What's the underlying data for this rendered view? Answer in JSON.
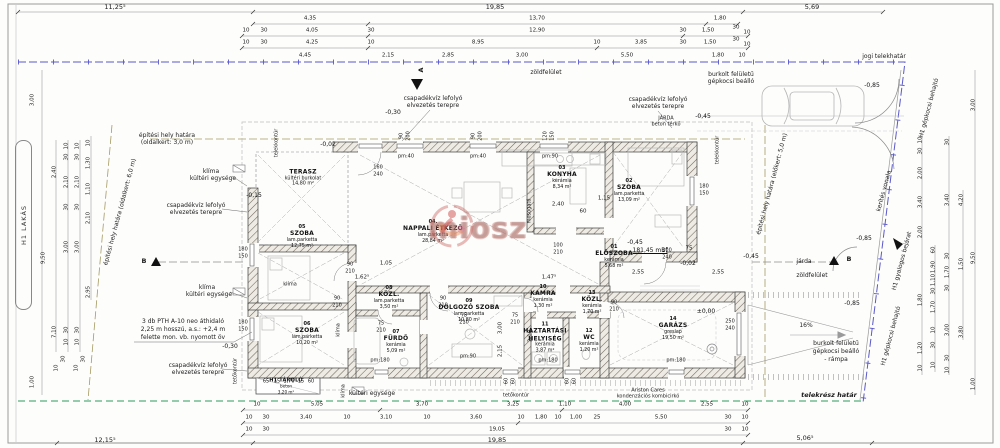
{
  "watermark": {
    "text": "miosz"
  },
  "markers": {
    "a": "A",
    "b": "B"
  },
  "site": {
    "jogi_telekhatar": "jogi telekhatár",
    "telekresz_hatar": "telekrész határ",
    "kerites_vonala": "kerítés vonala",
    "zoldfelulet_top": "zöldfelület",
    "zoldfelulet_bottom": "zöldfelület",
    "jarda_small": "járda",
    "jarda_line1": "JÁRDA",
    "jarda_line2": "beton térkő",
    "burkolt_line1": "burkolt felületű",
    "burkolt_line2": "gépkocsi beálló",
    "rampa_line1": "burkolt felületű",
    "rampa_line2": "gépkocsi beálló",
    "rampa_line3": "- rámpa",
    "slope": "16%",
    "h1_lakas": "H1 LAKÁS",
    "h1_gyalogos": "H1 gyalogos bejárat",
    "h1_gepkocsi": "H1 gépkocsi behajtó",
    "oldalkert3_line1": "építési hely határa",
    "oldalkert3_line2": "(oldalkert: 3,0 m)",
    "oldalkert6": "építési hely határa (oldalkert: 6,0 m)",
    "elokert5": "építési hely határa (előkert: 5,0 m)",
    "telekkontur": "telekkontúr",
    "tetokontur": "tetőkontúr"
  },
  "annotations": {
    "csapadek_line1": "csapadékvíz lefolyó",
    "csapadek_line2": "elvezetés terepre",
    "pth_line1": "3 db PTH A-10 neo áthidaló",
    "pth_line2": "2,25 m hosszú, a.s.: +2,4 m",
    "pth_line3": "felette mon. vb. nyomott öv",
    "klima": "klíma",
    "kulteri_egyseg": "kültéri egysége",
    "mosogato": "mosogató",
    "boiler_line1": "Ariston Cares",
    "boiler_line2": "kondenzációs kombicirkó",
    "benchmark": "181,45 mBf"
  },
  "levels": {
    "m002": "-0,02",
    "m015": "-0,15",
    "m030": "-0,30",
    "m045": "-0,45",
    "m085": "-0,85",
    "zero": "±0,00"
  },
  "rooms": [
    {
      "num": "01",
      "name": "ELŐSZOBA",
      "name2": "",
      "finish": "kerámia",
      "area": "5,68 m²"
    },
    {
      "num": "02",
      "name": "SZOBA",
      "name2": "",
      "finish": "lam.parketta",
      "area": "13,09 m²"
    },
    {
      "num": "03",
      "name": "KONYHA",
      "name2": "",
      "finish": "kerámia",
      "area": "8,34 m²"
    },
    {
      "num": "04.",
      "name": "NAPPALI ÉTKEZŐ",
      "name2": "",
      "finish": "lam.parketta",
      "area": "28,84 m²"
    },
    {
      "num": "05",
      "name": "SZOBA",
      "name2": "",
      "finish": "lam.parketta",
      "area": "12,75 m²"
    },
    {
      "num": "06",
      "name": "SZOBA",
      "name2": "",
      "finish": "lam.parketta",
      "area": "10,20 m²"
    },
    {
      "num": "07",
      "name": "FÜRDŐ",
      "name2": "",
      "finish": "kerámia",
      "area": "5,09 m²"
    },
    {
      "num": "08",
      "name": "KÖZL.",
      "name2": "",
      "finish": "lam.parketta",
      "area": "3,50 m²"
    },
    {
      "num": "09",
      "name": "DOLGOZÓ SZOBA",
      "name2": "",
      "finish": "lam.parketta",
      "area": "10,80 m²"
    },
    {
      "num": "10",
      "name": "KAMRA",
      "name2": "",
      "finish": "kerámia",
      "area": "1,30 m²"
    },
    {
      "num": "11",
      "name": "HÁZTARTÁSI",
      "name2": "HELYISÉG",
      "finish": "kerámia",
      "area": "3,87 m²"
    },
    {
      "num": "12",
      "name": "WC",
      "name2": "",
      "finish": "kerámia",
      "area": "1,20 m²"
    },
    {
      "num": "13",
      "name": "KÖZL.",
      "name2": "",
      "finish": "kerámia",
      "area": "1,70 m²"
    },
    {
      "num": "14",
      "name": "GARÁZS",
      "name2": "",
      "finish": "greslap",
      "area": "19,50 m²"
    },
    {
      "num": "",
      "name": "TERASZ",
      "name2": "",
      "finish": "kültéri burkolat",
      "area": "14,80 m²"
    },
    {
      "num": "",
      "name": "H1 TÁROLÓ",
      "name2": "",
      "finish": "beton",
      "area": "3,20 m²"
    }
  ],
  "dims": {
    "top1": [
      "11,25⁵",
      "19,85",
      "5,69"
    ],
    "top2": [
      "4,35",
      "13,70",
      "1,80"
    ],
    "top3": [
      "10",
      "30",
      "4,05",
      "30",
      "12,90",
      "30",
      "1,50",
      "30",
      "10"
    ],
    "top4": [
      "10",
      "30",
      "4,25",
      "10",
      "8,95",
      "10",
      "3,85",
      "30",
      "1,50",
      "30",
      "10"
    ],
    "top5": [
      "4,45",
      "2,15",
      "2,85",
      "3,00",
      "5,50",
      "1,80",
      "10"
    ],
    "bottom1": [
      "10",
      "5,05",
      "3,70",
      "3,25",
      "1,10",
      "4,00",
      "2,55",
      "10"
    ],
    "bottom2": [
      "10",
      "30",
      "3,40",
      "10",
      "3,10",
      "10",
      "3,60",
      "10",
      "1,80",
      "10",
      "1,00",
      "25",
      "5,50",
      "30",
      "10"
    ],
    "bottom3": [
      "10",
      "30",
      "19,05",
      "30",
      "10"
    ],
    "bottom4": [
      "12,15⁵",
      "19,85",
      "5,06⁵"
    ],
    "left": [
      "3,00",
      "9,50",
      "2,40",
      "7,10",
      "10",
      "30",
      "2,10",
      "30",
      "3,00",
      "30",
      "10",
      "10",
      "30",
      "2,10",
      "30",
      "3,00",
      "30",
      "10",
      "10",
      "1,30",
      "1,10",
      "2,10",
      "2,95",
      "1,00",
      "10",
      "30",
      "10",
      "30"
    ],
    "right": [
      "3,00",
      "9,50",
      "1,00",
      "4,20",
      "1,50",
      "3,80",
      "10",
      "30",
      "2,00",
      "3,40",
      "2,00",
      "1,80",
      "1,20",
      "10",
      "60",
      "1,90",
      "1,10",
      "30",
      "1,70",
      "10",
      "30",
      "10",
      "30",
      "3,40",
      "30",
      "1,70",
      "30",
      "3,00",
      "30",
      "10"
    ],
    "inner": [
      "1,05",
      "1,62⁵",
      "1,47⁵",
      "2,40",
      "60",
      "1,15",
      "2,55",
      "2,55",
      "3,00",
      "2,15",
      "2,10",
      "65",
      "15",
      "1,70",
      "15",
      "60",
      "75"
    ]
  },
  "openings": {
    "pairs": [
      {
        "a": "90",
        "b": "210"
      },
      {
        "a": "90",
        "b": "210"
      },
      {
        "a": "90",
        "b": "210"
      },
      {
        "a": "90",
        "b": "210"
      },
      {
        "a": "75",
        "b": "210"
      },
      {
        "a": "75",
        "b": "210"
      },
      {
        "a": "75",
        "b": "210"
      },
      {
        "a": "100",
        "b": "210"
      },
      {
        "a": "100",
        "b": "240"
      },
      {
        "a": "250",
        "b": "240"
      },
      {
        "a": "160",
        "b": "240"
      },
      {
        "a": "180",
        "b": "150"
      },
      {
        "a": "180",
        "b": "150"
      },
      {
        "a": "180",
        "b": "150"
      }
    ],
    "top": [
      {
        "a": "90",
        "b": "200",
        "pm": "pm:40"
      },
      {
        "a": "90",
        "b": "200",
        "pm": "pm:40"
      },
      {
        "a": "120",
        "b": "150",
        "pm": "pm:90"
      }
    ],
    "pm180": "pm:180",
    "pm90": "pm:90",
    "s60": "60"
  }
}
